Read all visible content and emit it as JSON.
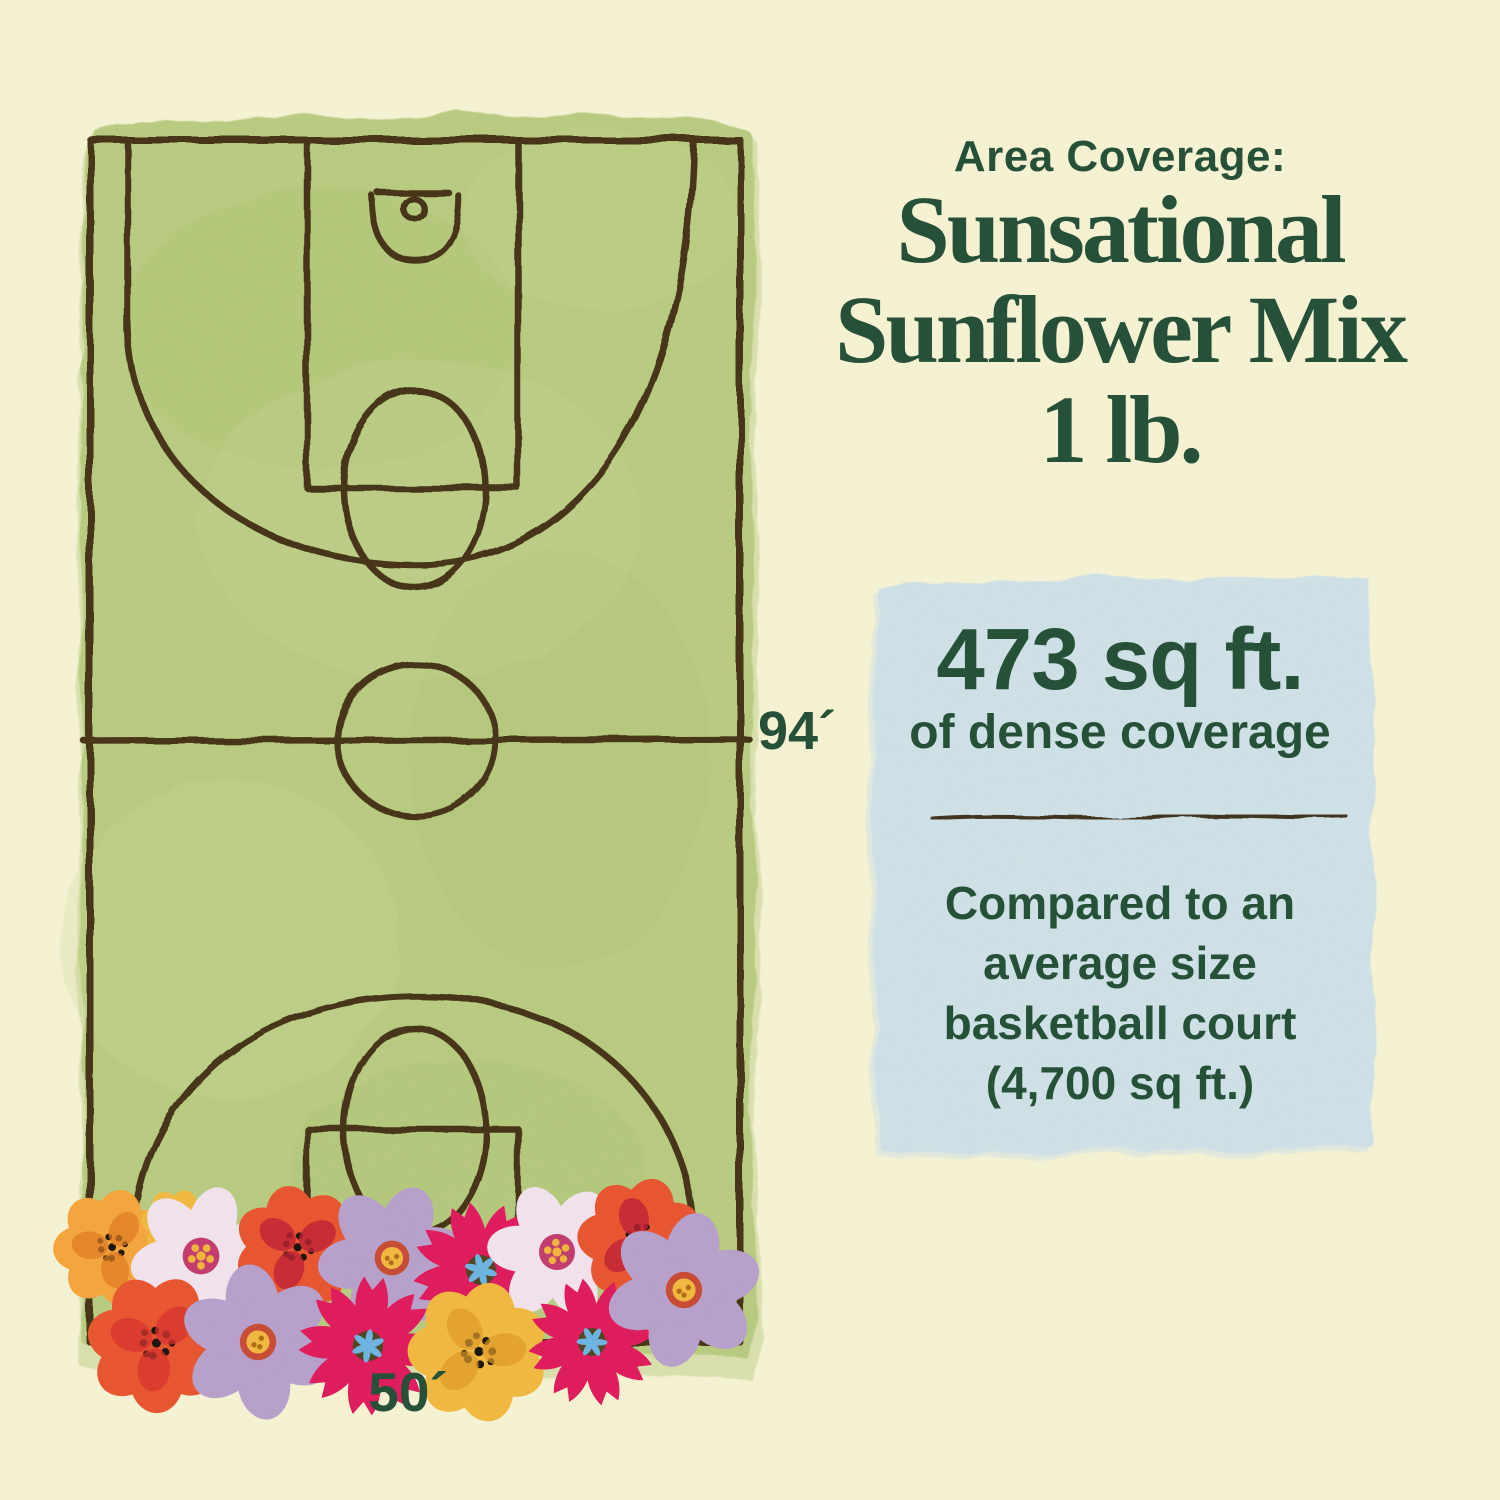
{
  "palette": {
    "background": "#f7f4d5",
    "text_green": "#265138",
    "court_green": "#b9cc81",
    "court_patch_dark": "#a3bb66",
    "court_patch_light": "#cdd99a",
    "court_line_brown": "#453214",
    "coverage_box_blue": "#cfe2e9",
    "divider_brown": "#3c301b",
    "flower_orange": "#f5a53c",
    "flower_red": "#e8542f",
    "flower_yellow": "#f2b93f",
    "flower_magenta": "#e0195c",
    "flower_pink": "#f2e3ee",
    "flower_lavender": "#b7a0cb"
  },
  "header": {
    "eyebrow": "Area Coverage:",
    "title_lines": [
      "Sunsational",
      "Sunflower Mix",
      "1 lb."
    ]
  },
  "court_diagram": {
    "length_label": "94´",
    "width_label": "50´"
  },
  "coverage_box": {
    "stat_value": "473 sq ft.",
    "stat_caption": "of dense coverage",
    "comparison_lines": [
      "Compared to an",
      "average size",
      "basketball court",
      "(4,700 sq ft.)"
    ]
  }
}
